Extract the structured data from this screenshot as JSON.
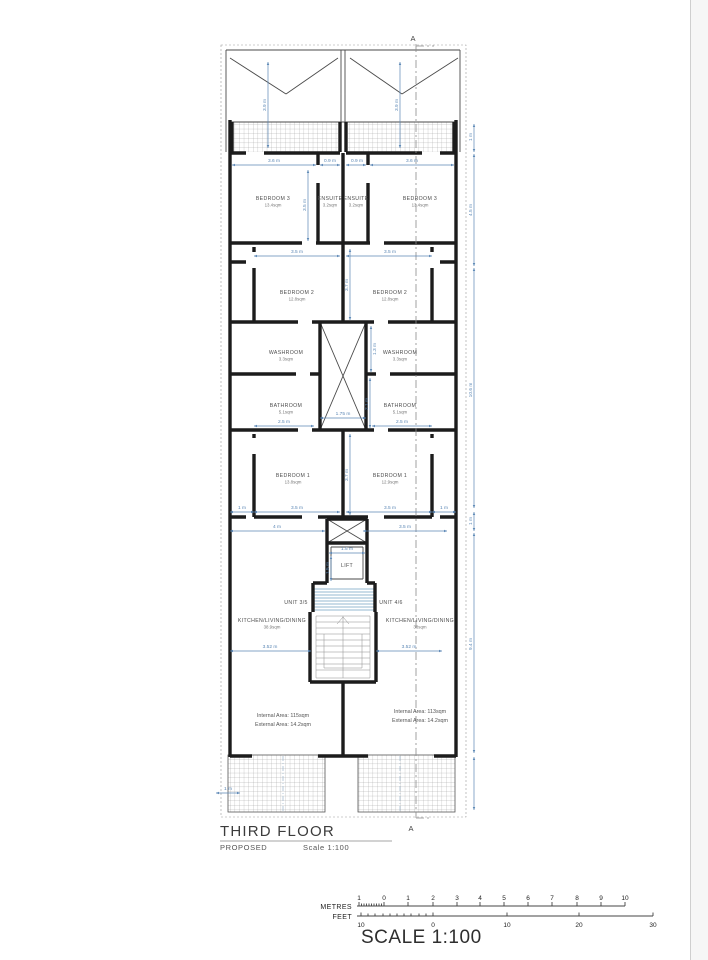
{
  "page": {
    "background": "#ffffff",
    "margin_line_color": "#cfcfcf"
  },
  "title_block": {
    "title": "THIRD FLOOR",
    "subtitle": "PROPOSED",
    "scale_note": "Scale 1:100"
  },
  "section_marker": "A",
  "scale_bar": {
    "metres_label": "METRES",
    "feet_label": "FEET",
    "title": "SCALE 1:100",
    "metres_ticks": [
      {
        "v": "1",
        "x": 359
      },
      {
        "v": "0",
        "x": 384
      },
      {
        "v": "1",
        "x": 408
      },
      {
        "v": "2",
        "x": 433
      },
      {
        "v": "3",
        "x": 457
      },
      {
        "v": "4",
        "x": 480
      },
      {
        "v": "5",
        "x": 504
      },
      {
        "v": "6",
        "x": 528
      },
      {
        "v": "7",
        "x": 552
      },
      {
        "v": "8",
        "x": 577
      },
      {
        "v": "9",
        "x": 601
      },
      {
        "v": "10",
        "x": 625
      }
    ],
    "feet_ticks": [
      {
        "v": "10",
        "x": 361
      },
      {
        "v": "0",
        "x": 433
      },
      {
        "v": "10",
        "x": 507
      },
      {
        "v": "20",
        "x": 579
      },
      {
        "v": "30",
        "x": 653
      }
    ]
  },
  "plan": {
    "colors": {
      "wall": "#1c1c1c",
      "dim_blue": "#5b87b5",
      "hatch": "#9a9a9a"
    },
    "rooms": [
      {
        "name": "bedroom3-left",
        "label": "BEDROOM 3",
        "area": "13.4sqm",
        "x": 273,
        "y": 200
      },
      {
        "name": "ensuite-left",
        "label": "ENSUITE",
        "area": "3.2sqm",
        "x": 330,
        "y": 200
      },
      {
        "name": "ensuite-right",
        "label": "ENSUITE",
        "area": "3.2sqm",
        "x": 356,
        "y": 200
      },
      {
        "name": "bedroom3-right",
        "label": "BEDROOM 3",
        "area": "13.4sqm",
        "x": 420,
        "y": 200
      },
      {
        "name": "bedroom2-left",
        "label": "BEDROOM 2",
        "area": "12.8sqm",
        "x": 297,
        "y": 294
      },
      {
        "name": "bedroom2-right",
        "label": "BEDROOM 2",
        "area": "12.8sqm",
        "x": 390,
        "y": 294
      },
      {
        "name": "washroom-left",
        "label": "WASHROOM",
        "area": "3.3sqm",
        "x": 286,
        "y": 354
      },
      {
        "name": "washroom-right",
        "label": "WASHROOM",
        "area": "3.3sqm",
        "x": 400,
        "y": 354
      },
      {
        "name": "bathroom-left",
        "label": "BATHROOM",
        "area": "5.1sqm",
        "x": 286,
        "y": 407
      },
      {
        "name": "bathroom-right",
        "label": "BATHROOM",
        "area": "5.1sqm",
        "x": 400,
        "y": 407
      },
      {
        "name": "bedroom1-left",
        "label": "BEDROOM 1",
        "area": "13.8sqm",
        "x": 293,
        "y": 477
      },
      {
        "name": "bedroom1-right",
        "label": "BEDROOM 1",
        "area": "12.9sqm",
        "x": 390,
        "y": 477
      },
      {
        "name": "lift",
        "label": "LIFT",
        "area": "",
        "x": 347,
        "y": 567
      },
      {
        "name": "unit-3-5",
        "label": "UNIT 3/5",
        "area": "",
        "x": 296,
        "y": 604
      },
      {
        "name": "unit-4-6",
        "label": "UNIT 4/6",
        "area": "",
        "x": 391,
        "y": 604
      },
      {
        "name": "kitchen-left",
        "label": "KITCHEN/LIVING/DINING",
        "area": "38.9sqm",
        "x": 272,
        "y": 622
      },
      {
        "name": "kitchen-right",
        "label": "KITCHEN/LIVING/DINING",
        "area": "38sqm",
        "x": 420,
        "y": 622
      }
    ],
    "area_notes": [
      {
        "x": 283,
        "y": 717,
        "lines": [
          "Internal Area: 115sqm",
          "External Area: 14.2sqm"
        ]
      },
      {
        "x": 420,
        "y": 713,
        "lines": [
          "Internal Area: 113sqm",
          "External Area: 14.2sqm"
        ]
      }
    ],
    "dims": [
      {
        "t": "3.6 m",
        "x": 274,
        "y": 162,
        "r": 0
      },
      {
        "t": "0.9 m",
        "x": 330,
        "y": 162,
        "r": 0
      },
      {
        "t": "0.9 m",
        "x": 357,
        "y": 162,
        "r": 0
      },
      {
        "t": "3.6 m",
        "x": 412,
        "y": 162,
        "r": 0
      },
      {
        "t": "3.5 m",
        "x": 297,
        "y": 253,
        "r": 0
      },
      {
        "t": "3.5 m",
        "x": 390,
        "y": 253,
        "r": 0
      },
      {
        "t": "2.5 m",
        "x": 284,
        "y": 423,
        "r": 0
      },
      {
        "t": "2.5 m",
        "x": 402,
        "y": 423,
        "r": 0
      },
      {
        "t": "1.75 m",
        "x": 343,
        "y": 415,
        "r": 0
      },
      {
        "t": "1 m",
        "x": 242,
        "y": 509,
        "r": 0
      },
      {
        "t": "3.5 m",
        "x": 297,
        "y": 509,
        "r": 0
      },
      {
        "t": "3.5 m",
        "x": 390,
        "y": 509,
        "r": 0
      },
      {
        "t": "1 m",
        "x": 444,
        "y": 509,
        "r": 0
      },
      {
        "t": "4 m",
        "x": 277,
        "y": 528,
        "r": 0
      },
      {
        "t": "3.5 m",
        "x": 405,
        "y": 528,
        "r": 0
      },
      {
        "t": "1.5 m",
        "x": 347,
        "y": 550,
        "r": 0
      },
      {
        "t": "3.52 m",
        "x": 270,
        "y": 648,
        "r": 0
      },
      {
        "t": "3.52 m",
        "x": 409,
        "y": 648,
        "r": 0
      },
      {
        "t": "1 m",
        "x": 228,
        "y": 790,
        "r": 0
      },
      {
        "t": "3.9 m",
        "x": 266,
        "y": 105,
        "r": 1
      },
      {
        "t": "3.9 m",
        "x": 398,
        "y": 105,
        "r": 1
      },
      {
        "t": "3.5 m",
        "x": 306,
        "y": 205,
        "r": 1
      },
      {
        "t": "3.7 m",
        "x": 348,
        "y": 285,
        "r": 1
      },
      {
        "t": "1.3 m",
        "x": 376,
        "y": 349,
        "r": 1
      },
      {
        "t": "2.1 m",
        "x": 368,
        "y": 404,
        "r": 1
      },
      {
        "t": "3.7 m",
        "x": 348,
        "y": 475,
        "r": 1
      },
      {
        "t": "1.5 m",
        "x": 329,
        "y": 568,
        "r": 1
      },
      {
        "t": "1 m",
        "x": 472,
        "y": 137,
        "r": 1
      },
      {
        "t": "4.5 m",
        "x": 472,
        "y": 210,
        "r": 1
      },
      {
        "t": "10.6 m",
        "x": 472,
        "y": 390,
        "r": 1
      },
      {
        "t": "1 m",
        "x": 472,
        "y": 521,
        "r": 1
      },
      {
        "t": "9.4 m",
        "x": 472,
        "y": 644,
        "r": 1
      }
    ]
  }
}
